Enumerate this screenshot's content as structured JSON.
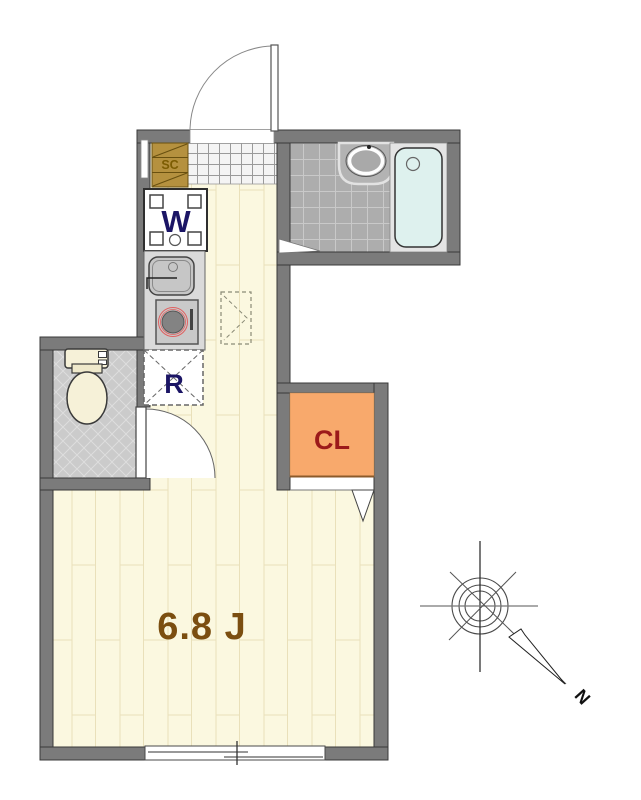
{
  "floorplan": {
    "labels": {
      "main_room": "6.8 J",
      "closet": "CL",
      "washing_machine": "W",
      "refrigerator": "R",
      "shoe_cabinet": "SC",
      "north": "N"
    },
    "colors": {
      "wall": "#7b7b7b",
      "flooring": "#fbf8e0",
      "genkan_tile": "#f4f4f4",
      "bathroom_tile": "#adadad",
      "toilet_floor": "#cbcbcb",
      "closet_fill": "#f8a96c",
      "bathtub_fill": "#def1ee",
      "shoe_cabinet_fill": "#b5913f",
      "main_room_label_color": "#7b4e10",
      "closet_label_color": "#9c1a1a",
      "appliance_label_color": "#1b1565",
      "shoe_cabinet_label_color": "#7c5c02"
    }
  }
}
